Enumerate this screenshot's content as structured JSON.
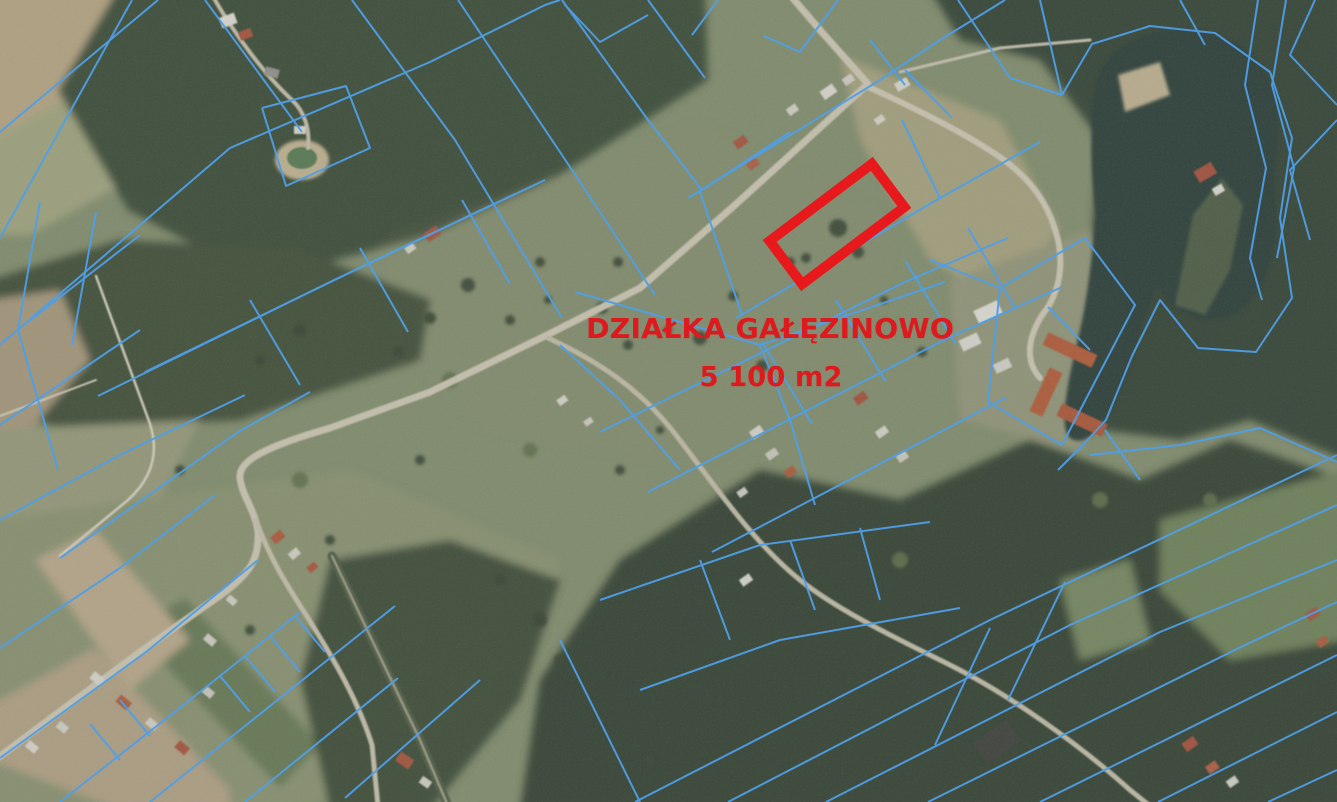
{
  "annotation": {
    "line1": "DZIAŁKA GAŁĘZINOWO",
    "line2": "5 100 m2",
    "text_color": "#dd1a1e",
    "highlight_color": "#e8191c"
  },
  "overlay": {
    "parcel_line_color": "#4f9fe8"
  }
}
